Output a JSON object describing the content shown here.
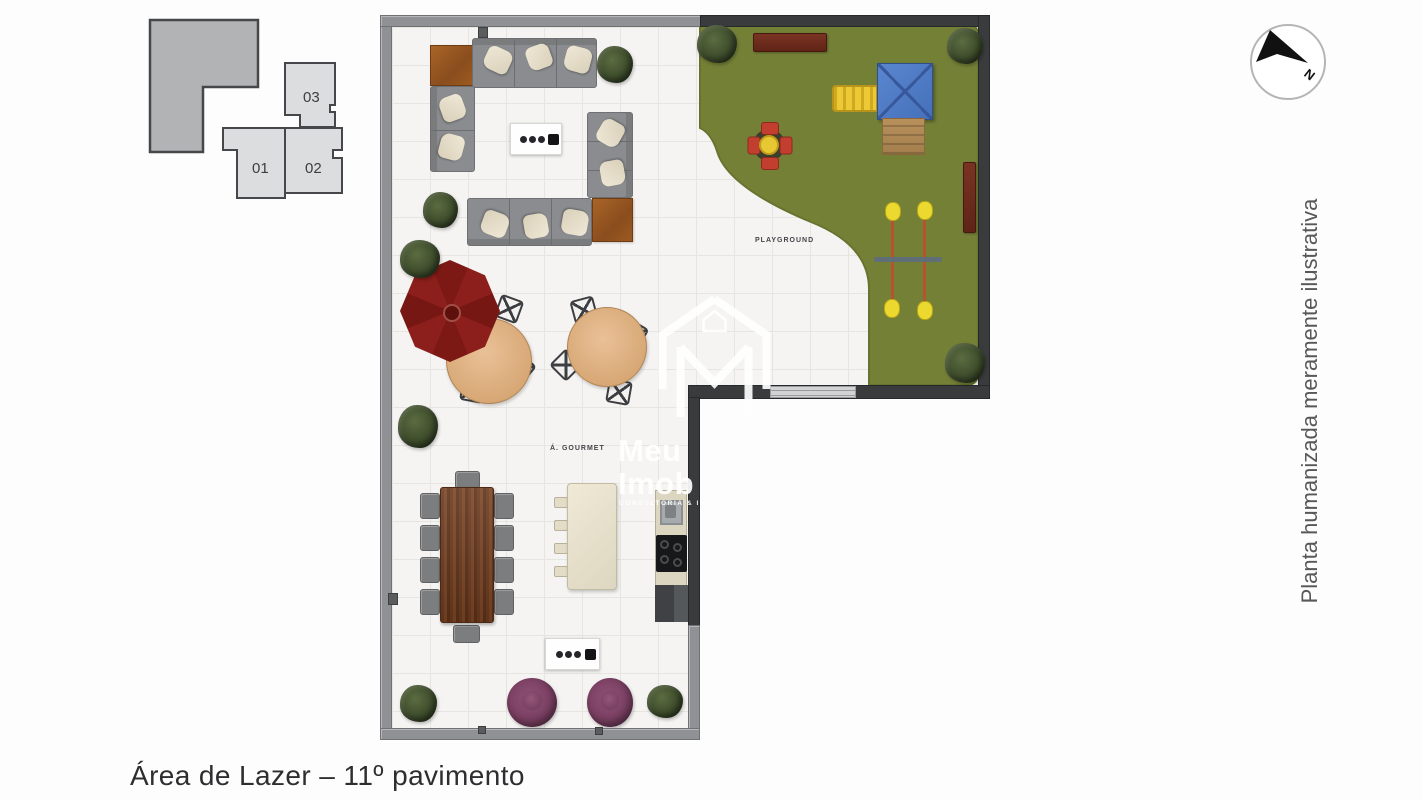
{
  "title": "Área de Lazer – 11º pavimento",
  "side_note": "Planta humanizada meramente ilustrativa",
  "compass": {
    "label": "N"
  },
  "key_plan": {
    "units": [
      {
        "id": "01"
      },
      {
        "id": "02"
      },
      {
        "id": "03"
      }
    ]
  },
  "plan": {
    "labels": {
      "playground": "PLAYGROUND",
      "gourmet": "Á. GOURMET"
    }
  },
  "watermark": {
    "brand_line1": "Meu",
    "brand_line2": "Imob",
    "tagline": "CONSULTORIA & IN"
  },
  "palette": {
    "wall_dark": "#3a3b3d",
    "wall_light": "#8f9194",
    "floor_tile": "#f5f4f2",
    "grass_green": "#758037",
    "umbrella_red": "#8c1f1b",
    "bench_maroon": "#6b2b1e",
    "roof_blue": "#4d7ac5",
    "play_yellow": "#e8c62e",
    "pouf_plum": "#7b4063",
    "dining_wood": "#6f3c1e",
    "round_table_wood": "#ddab7a"
  }
}
